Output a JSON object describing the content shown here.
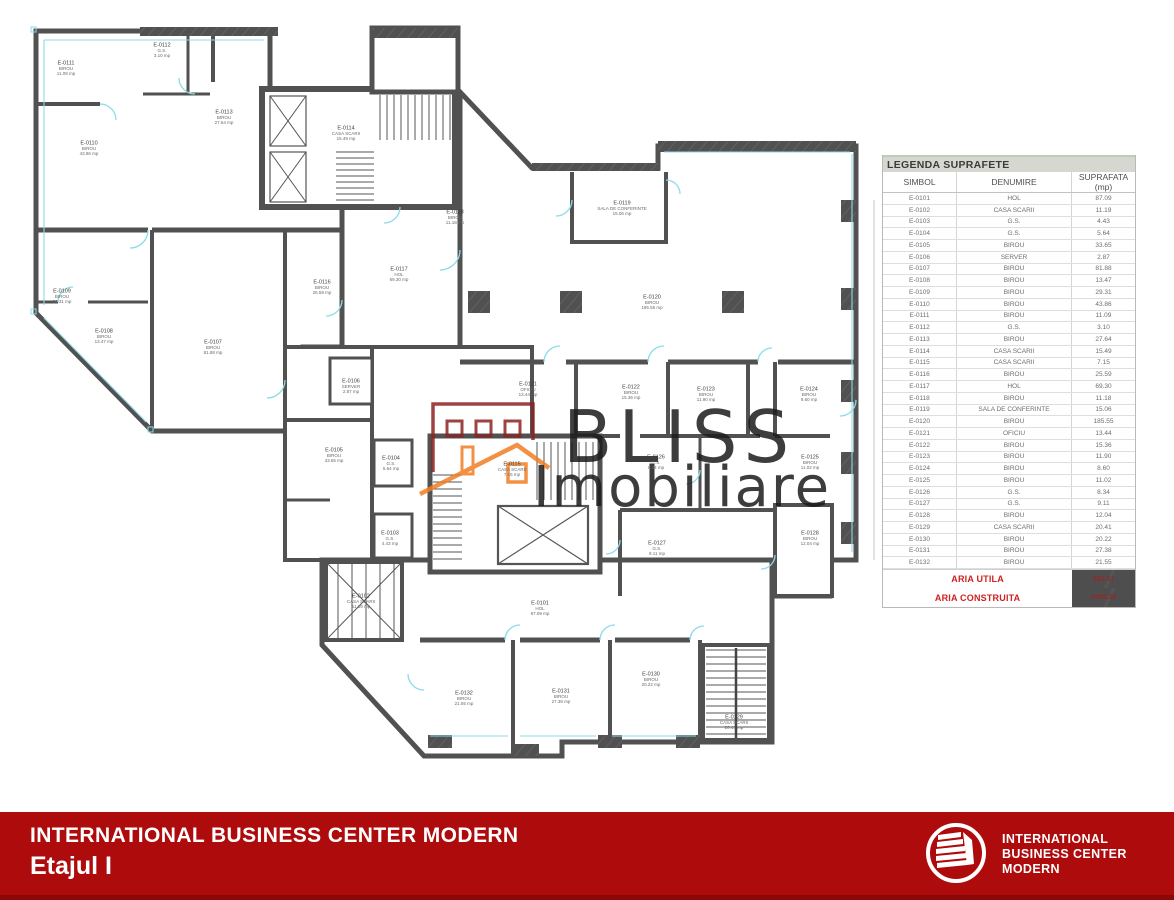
{
  "legend": {
    "title": "LEGENDA SUPRAFETE",
    "columns": [
      "SIMBOL",
      "DENUMIRE",
      "SUPRAFATA (mp)"
    ],
    "rows": [
      {
        "symbol": "E-0101",
        "name": "HOL",
        "area": "87.09"
      },
      {
        "symbol": "E-0102",
        "name": "CASA SCARII",
        "area": "11.19"
      },
      {
        "symbol": "E-0103",
        "name": "G.S.",
        "area": "4.43"
      },
      {
        "symbol": "E-0104",
        "name": "G.S.",
        "area": "5.64"
      },
      {
        "symbol": "E-0105",
        "name": "BIROU",
        "area": "33.65"
      },
      {
        "symbol": "E-0106",
        "name": "SERVER",
        "area": "2.87"
      },
      {
        "symbol": "E-0107",
        "name": "BIROU",
        "area": "81.88"
      },
      {
        "symbol": "E-0108",
        "name": "BIROU",
        "area": "13.47"
      },
      {
        "symbol": "E-0109",
        "name": "BIROU",
        "area": "29.31"
      },
      {
        "symbol": "E-0110",
        "name": "BIROU",
        "area": "43.86"
      },
      {
        "symbol": "E-0111",
        "name": "BIROU",
        "area": "11.09"
      },
      {
        "symbol": "E-0112",
        "name": "G.S.",
        "area": "3.10"
      },
      {
        "symbol": "E-0113",
        "name": "BIROU",
        "area": "27.64"
      },
      {
        "symbol": "E-0114",
        "name": "CASA SCARII",
        "area": "15.49"
      },
      {
        "symbol": "E-0115",
        "name": "CASA SCARII",
        "area": "7.15"
      },
      {
        "symbol": "E-0116",
        "name": "BIROU",
        "area": "25.59"
      },
      {
        "symbol": "E-0117",
        "name": "HOL",
        "area": "69.30"
      },
      {
        "symbol": "E-0118",
        "name": "BIROU",
        "area": "11.18"
      },
      {
        "symbol": "E-0119",
        "name": "SALA DE CONFERINTE",
        "area": "15.06"
      },
      {
        "symbol": "E-0120",
        "name": "BIROU",
        "area": "185.55"
      },
      {
        "symbol": "E-0121",
        "name": "OFICIU",
        "area": "13.44"
      },
      {
        "symbol": "E-0122",
        "name": "BIROU",
        "area": "15.36"
      },
      {
        "symbol": "E-0123",
        "name": "BIROU",
        "area": "11.90"
      },
      {
        "symbol": "E-0124",
        "name": "BIROU",
        "area": "8.60"
      },
      {
        "symbol": "E-0125",
        "name": "BIROU",
        "area": "11.02"
      },
      {
        "symbol": "E-0126",
        "name": "G.S.",
        "area": "8.34"
      },
      {
        "symbol": "E-0127",
        "name": "G.S.",
        "area": "9.11"
      },
      {
        "symbol": "E-0128",
        "name": "BIROU",
        "area": "12.04"
      },
      {
        "symbol": "E-0129",
        "name": "CASA SCARII",
        "area": "20.41"
      },
      {
        "symbol": "E-0130",
        "name": "BIROU",
        "area": "20.22"
      },
      {
        "symbol": "E-0131",
        "name": "BIROU",
        "area": "27.38"
      },
      {
        "symbol": "E-0132",
        "name": "BIROU",
        "area": "21.55"
      }
    ],
    "aria_utila_label": "ARIA UTILA",
    "aria_utila_value": "863.91",
    "aria_construita_label": "ARIA CONSTRUITA",
    "aria_construita_value": "1005.36"
  },
  "plan": {
    "area_suffix": "mp",
    "labels": [
      {
        "id": "E-0101",
        "x": 540,
        "y": 608
      },
      {
        "id": "E-0102",
        "x": 361,
        "y": 601
      },
      {
        "id": "E-0103",
        "x": 390,
        "y": 538
      },
      {
        "id": "E-0104",
        "x": 391,
        "y": 463
      },
      {
        "id": "E-0105",
        "x": 334,
        "y": 455
      },
      {
        "id": "E-0106",
        "x": 351,
        "y": 386
      },
      {
        "id": "E-0107",
        "x": 213,
        "y": 347
      },
      {
        "id": "E-0108",
        "x": 104,
        "y": 336
      },
      {
        "id": "E-0109",
        "x": 62,
        "y": 296
      },
      {
        "id": "E-0110",
        "x": 89,
        "y": 148
      },
      {
        "id": "E-0111",
        "x": 66,
        "y": 68
      },
      {
        "id": "E-0112",
        "x": 162,
        "y": 50
      },
      {
        "id": "E-0113",
        "x": 224,
        "y": 117
      },
      {
        "id": "E-0114",
        "x": 346,
        "y": 133
      },
      {
        "id": "E-0115",
        "x": 512,
        "y": 469
      },
      {
        "id": "E-0116",
        "x": 322,
        "y": 287
      },
      {
        "id": "E-0117",
        "x": 399,
        "y": 274
      },
      {
        "id": "E-0118",
        "x": 455,
        "y": 217
      },
      {
        "id": "E-0119",
        "x": 622,
        "y": 208
      },
      {
        "id": "E-0120",
        "x": 652,
        "y": 302
      },
      {
        "id": "E-0121",
        "x": 528,
        "y": 389
      },
      {
        "id": "E-0122",
        "x": 631,
        "y": 392
      },
      {
        "id": "E-0123",
        "x": 706,
        "y": 394
      },
      {
        "id": "E-0124",
        "x": 809,
        "y": 394
      },
      {
        "id": "E-0125",
        "x": 810,
        "y": 462
      },
      {
        "id": "E-0126",
        "x": 656,
        "y": 462
      },
      {
        "id": "E-0127",
        "x": 657,
        "y": 548
      },
      {
        "id": "E-0128",
        "x": 810,
        "y": 538
      },
      {
        "id": "E-0129",
        "x": 734,
        "y": 722
      },
      {
        "id": "E-0130",
        "x": 651,
        "y": 679
      },
      {
        "id": "E-0131",
        "x": 561,
        "y": 696
      },
      {
        "id": "E-0132",
        "x": 464,
        "y": 698
      }
    ]
  },
  "watermark": {
    "line1": "BLISS",
    "line2": "Imobiliare"
  },
  "footer": {
    "title": "INTERNATIONAL BUSINESS CENTER MODERN",
    "subtitle": "Etajul I",
    "logo_lines": [
      "INTERNATIONAL",
      "BUSINESS CENTER",
      "MODERN"
    ]
  },
  "colors": {
    "banner_red": "#ae0b0c",
    "banner_red_dark": "#8b0808",
    "legend_red": "#d02020",
    "wall_gray": "#515151",
    "door_cyan": "#8adbe8",
    "watermark_red": "#8e2222",
    "watermark_orange": "#f07e24",
    "obscured_box_gray": "#4e4e4e"
  }
}
